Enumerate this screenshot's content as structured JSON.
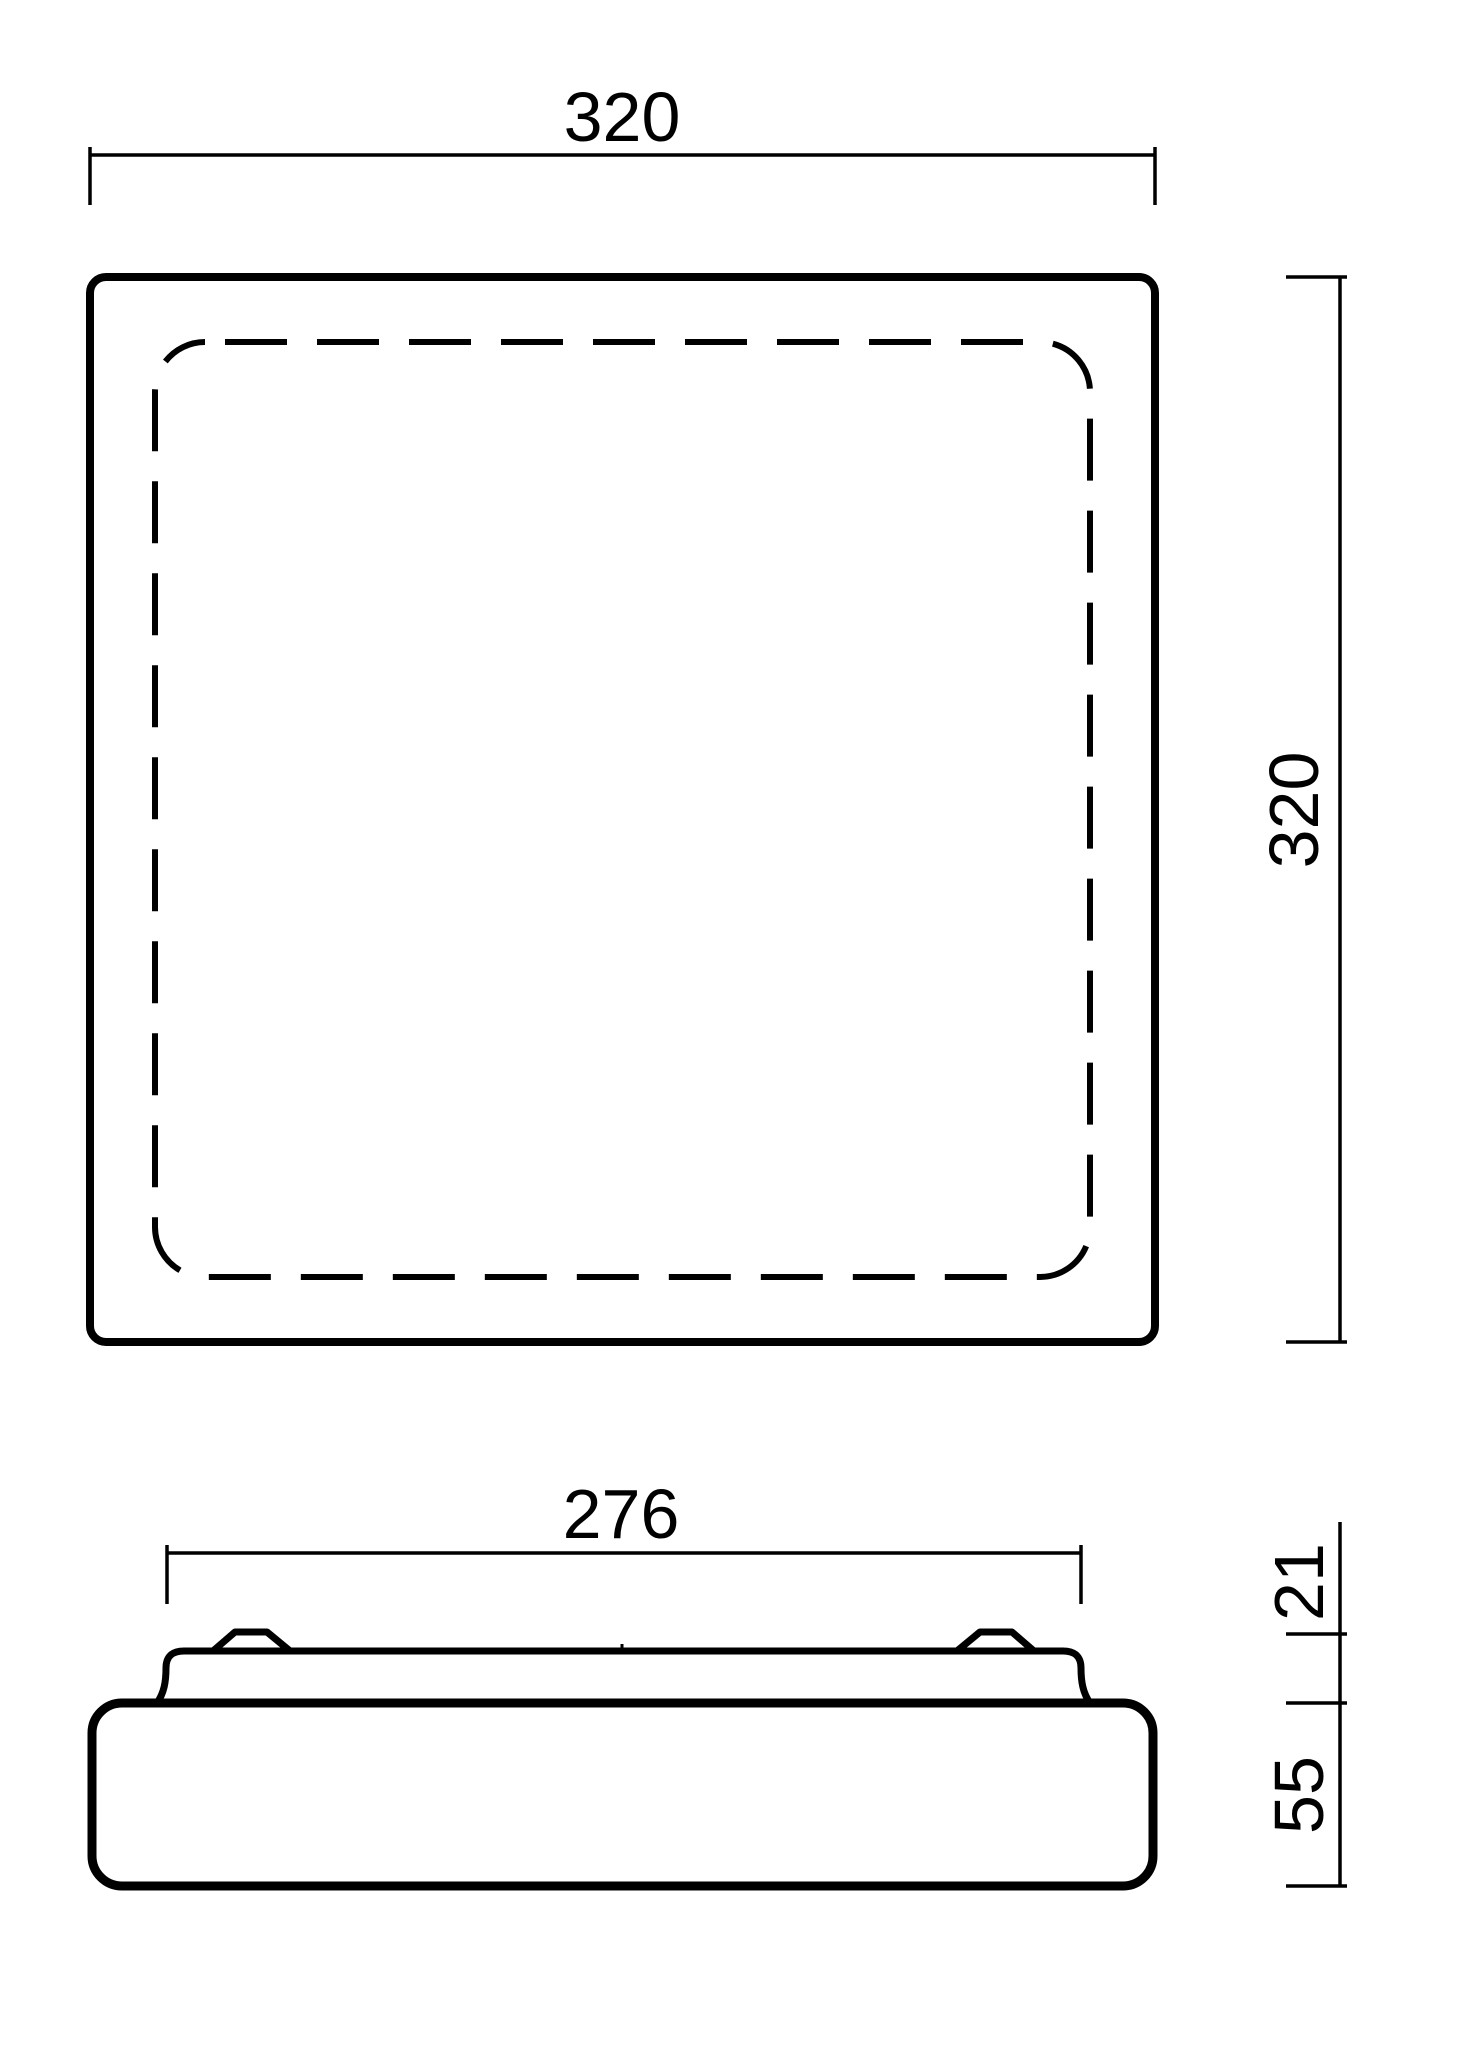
{
  "colors": {
    "ink": "#000000",
    "background": "#ffffff"
  },
  "views": {
    "top": {
      "label_width": "320",
      "label_height": "320"
    },
    "side": {
      "label_width": "276",
      "label_top_height": "21",
      "label_base_height": "55"
    }
  }
}
